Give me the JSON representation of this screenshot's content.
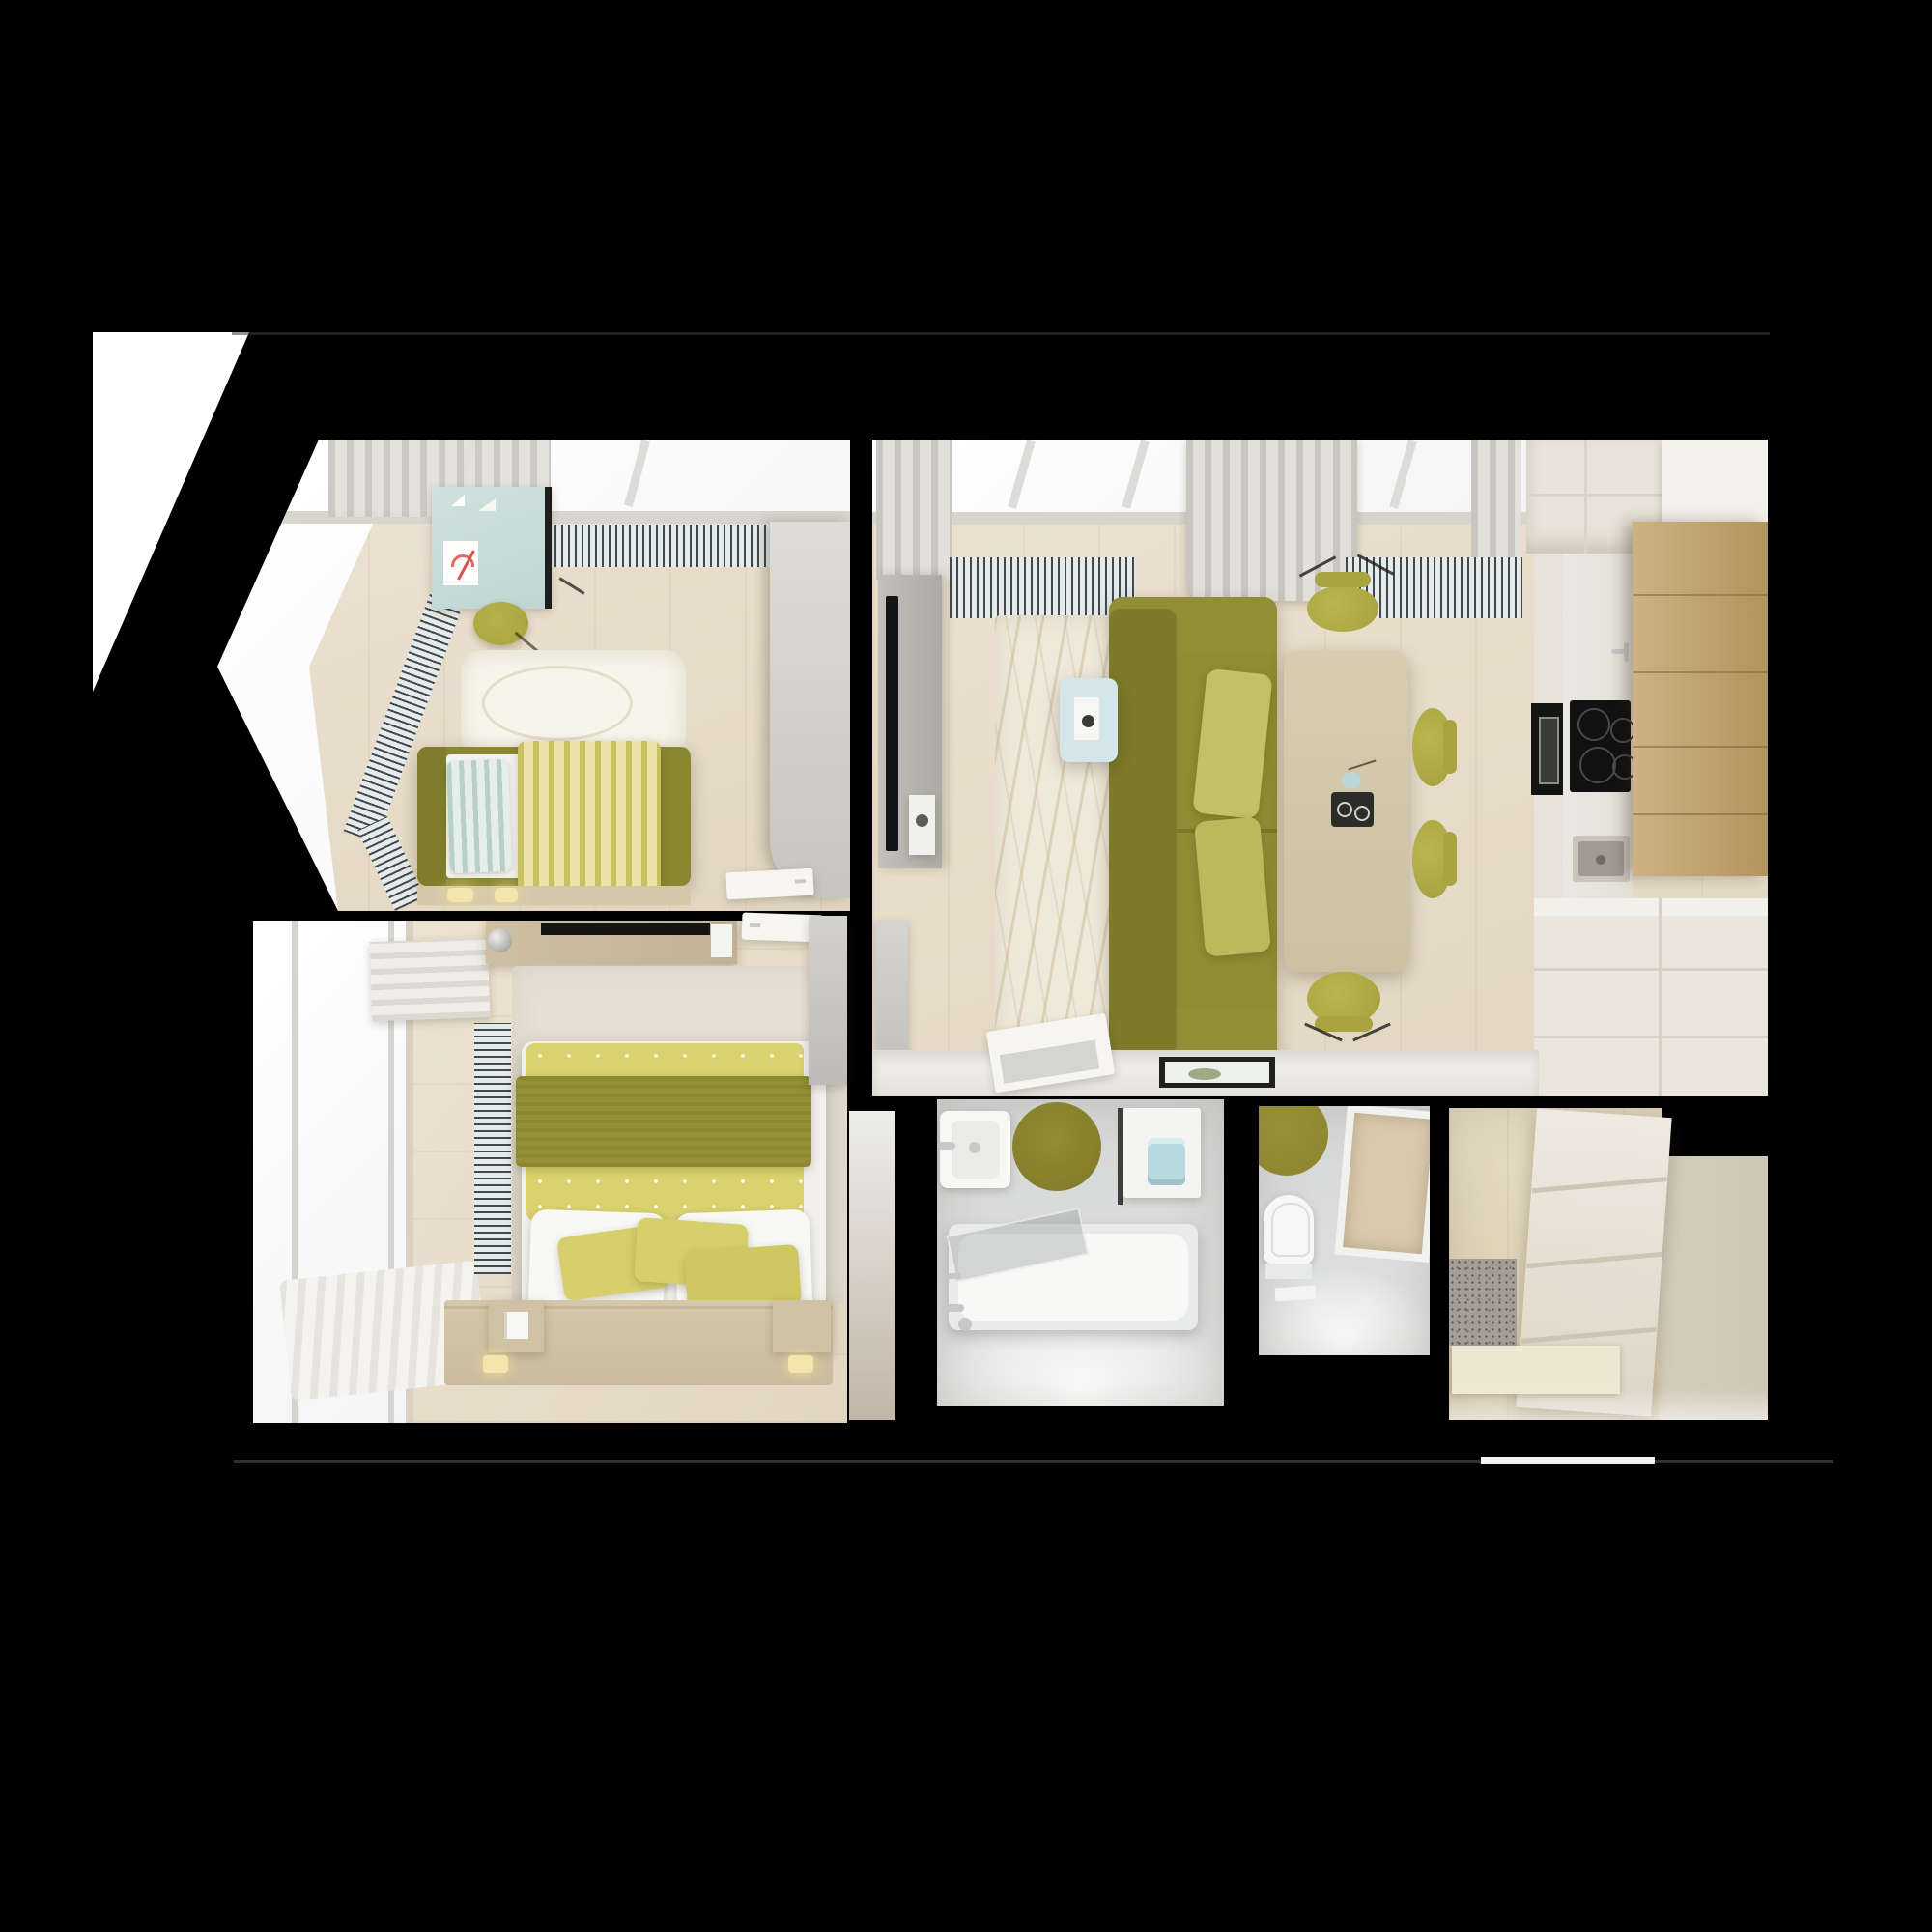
{
  "scene": {
    "type": "3d-floorplan-render",
    "view": "top-down",
    "description": "Top-down 3D render of a one-bedroom apartment floor plan on a black background: kids room, bedroom, living room with kitchen, bathroom, toilet and entry hallway in white, beige and olive-green tones"
  },
  "colors": {
    "canvas": "#000000",
    "exterior": "#ffffff",
    "edgeLine": "#3d3d3d",
    "windowLight": "#f3f4f3",
    "cornice": "#d8d5cf",
    "curtain": "#e3e0db",
    "curtainDark": "#c9c6c0",
    "radiatorDark": "#3f4a4e",
    "radiatorLight": "#e6ebea",
    "floorWood": "#ece2d0",
    "floorWoodDark": "#e2d6c1",
    "floorHall": "#e6dcc4",
    "floorHallDark": "#d9ccb0",
    "tile": "#d5d6d6",
    "tileGlow": "#ffffff",
    "olive": "#8f8c33",
    "oliveDark": "#7d7a2a",
    "oliveMid": "#918e36",
    "olivePillow": "#c4c065",
    "kidsFrame": "#8a8731",
    "kidsHead": "#7f7c2b",
    "blanketA": "#c9c063",
    "blanketB": "#ebe4a6",
    "pillowA": "#b9cfca",
    "pillowB": "#e6eeeb",
    "yellowDuvet": "#d9d26e",
    "duvetBand": "#8c8830",
    "smallPillow": "#d7cf6b",
    "whitePillow": "#f8f8f6",
    "mint": "#cfe1de",
    "mintDark": "#bfd6d3",
    "chairOlive": "#b6b24a",
    "chairBack": "#a8a440",
    "tableWood": "#d8ccb2",
    "tableWoodDark": "#cdc0a2",
    "tray": "#2c2c28",
    "blueTable": "#d4e6e9",
    "towel": "#b7d9e0",
    "tvPanel": "#bdbab5",
    "tvBlack": "#151515",
    "poster": "#f0f0ee",
    "rugCream": "#efe9dc",
    "bearRug": "#f7f4ea",
    "bedroomRug": "#e5e0d4",
    "platform": "#d5c8aa",
    "platformDark": "#c9bb9c",
    "nightstand": "#cfc1a3",
    "lampGlow": "#f3e5ac",
    "grayDoor": "#cfcdc9",
    "whiteDoor": "#f6f5f2",
    "ledge": "#f1f0ed",
    "kitchenCream": "#e8e3d9",
    "kitchenCounter": "#ebe9e2",
    "kitchenWood": "#cdb285",
    "kitchenWoodDark": "#b2945e",
    "applianceBlack": "#141412",
    "steel": "#c9c5bb",
    "steelDark": "#9f9b92",
    "wardrobe": "#eeeae1",
    "wardrobeSeam": "#cdc5b4",
    "wardrobeSide": "#d5ccbb",
    "matBase": "#a49e96",
    "matDot": "#5f5a53",
    "beigeCol": "#c2b6a6",
    "oliveRug": "#8b852f",
    "toiletWhite": "#f6f7f6",
    "chrome": "#c7c8c8",
    "paper": "#f2f3f2",
    "entry": "#f2f2f1",
    "blind": "#efede8",
    "blindLine": "#dcd9d3"
  },
  "rooms": [
    {
      "id": "kids-room",
      "items": [
        "bay-window",
        "curtain",
        "radiator-grilles",
        "kids-desk",
        "kids-drawing",
        "desk-chair",
        "polar-bear-rug",
        "single-bed",
        "striped-pillow",
        "striped-blanket",
        "bed-ledge",
        "bedside-lamps",
        "structural-column",
        "open-door"
      ]
    },
    {
      "id": "living-room",
      "items": [
        "skylight-windows",
        "curtains",
        "radiator-grilles",
        "tv-panel",
        "tv",
        "poster",
        "wavy-area-rug",
        "olive-sofa",
        "sofa-pillows",
        "blue-side-table",
        "book",
        "cup",
        "dining-table",
        "serving-tray",
        "vase",
        "dining-chairs",
        "partition-ledge",
        "open-door",
        "picture-frame"
      ]
    },
    {
      "id": "kitchen",
      "items": [
        "upper-cabinets",
        "cabinet-run",
        "stone-countertop",
        "built-in-oven",
        "induction-cooktop",
        "faucet",
        "steel-sink",
        "tall-wood-cabinet",
        "lower-cabinets"
      ]
    },
    {
      "id": "bedroom",
      "items": [
        "window",
        "roman-blind",
        "curtain",
        "radiator-grille",
        "vanity-desk",
        "desk-mat",
        "desk-lamp",
        "double-bed",
        "dotted-duvet",
        "olive-blanket",
        "white-pillows",
        "small-pillows",
        "bed-platform",
        "nightstands",
        "platform-lamps",
        "area-rug",
        "wardrobe-door"
      ]
    },
    {
      "id": "bathroom",
      "items": [
        "washbasin",
        "round-olive-rug",
        "washing-machine",
        "blue-towel",
        "bathtub",
        "glass-screen",
        "faucet-fixtures"
      ]
    },
    {
      "id": "toilet-room",
      "items": [
        "toilet",
        "round-olive-rug",
        "niche-shelf",
        "floor-paper"
      ]
    },
    {
      "id": "hallway",
      "items": [
        "drawer-wardrobe",
        "speckled-doormat",
        "floor-board",
        "entry-door"
      ]
    }
  ]
}
